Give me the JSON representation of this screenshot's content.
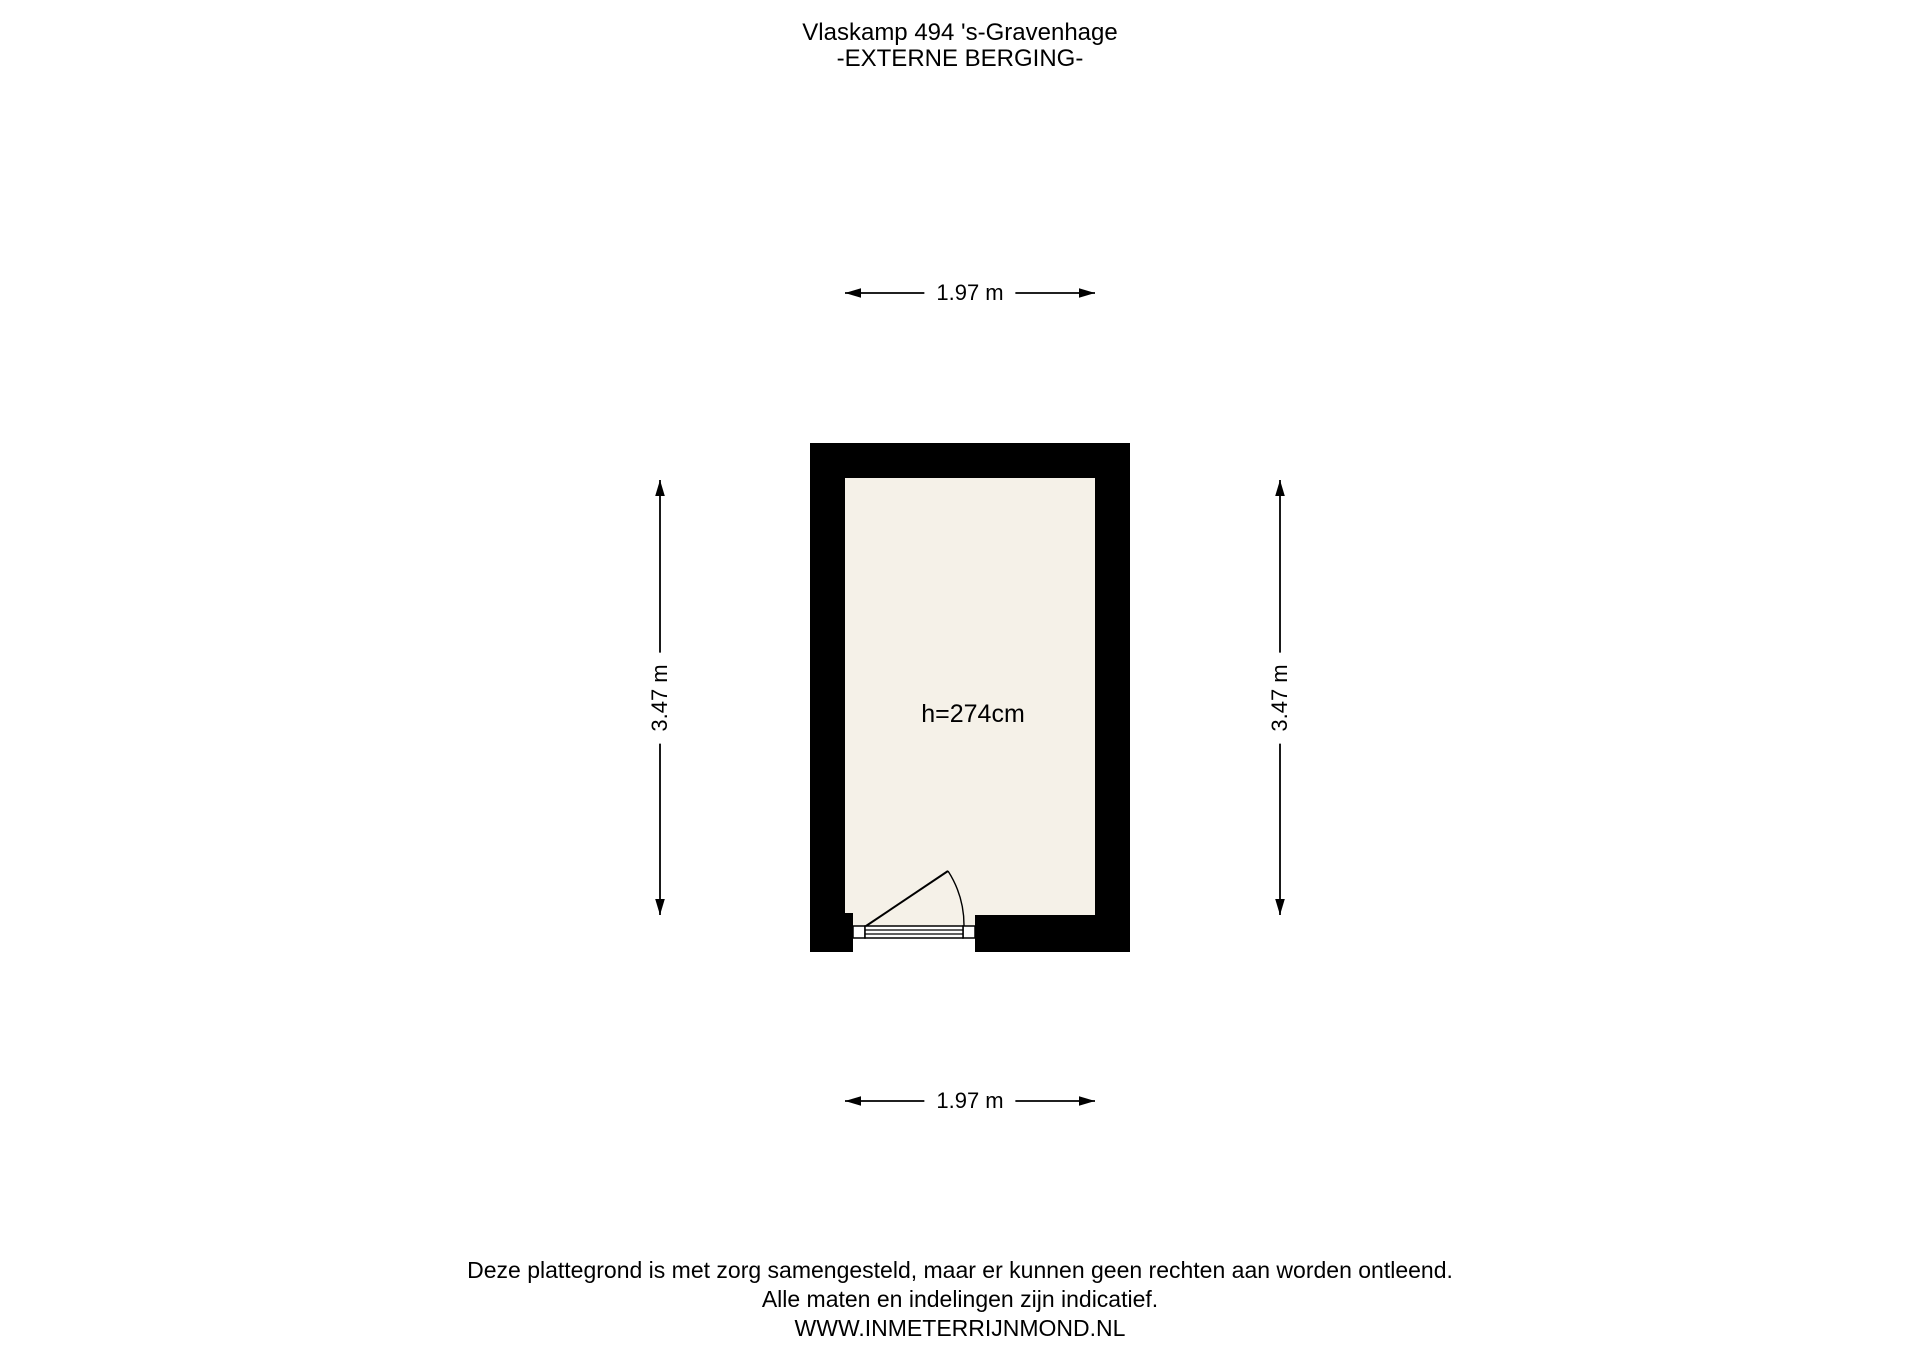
{
  "title": {
    "line1": "Vlaskamp 494 's-Gravenhage",
    "line2": "-EXTERNE BERGING-"
  },
  "plan": {
    "room": {
      "name": "externe berging",
      "height_label": "h=274cm"
    },
    "dimensions": {
      "top": "1.97 m",
      "bottom": "1.97 m",
      "left": "3.47 m",
      "right": "3.47 m"
    }
  },
  "footer": {
    "line1": "Deze plattegrond is met zorg samengesteld, maar er kunnen geen rechten aan worden ontleend.",
    "line2": "Alle maten en indelingen zijn indicatief.",
    "line3": "WWW.INMETERRIJNMOND.NL"
  },
  "colors": {
    "wall": "#000000",
    "floor": "#f5f1e8",
    "background": "#ffffff",
    "ink": "#000000"
  }
}
